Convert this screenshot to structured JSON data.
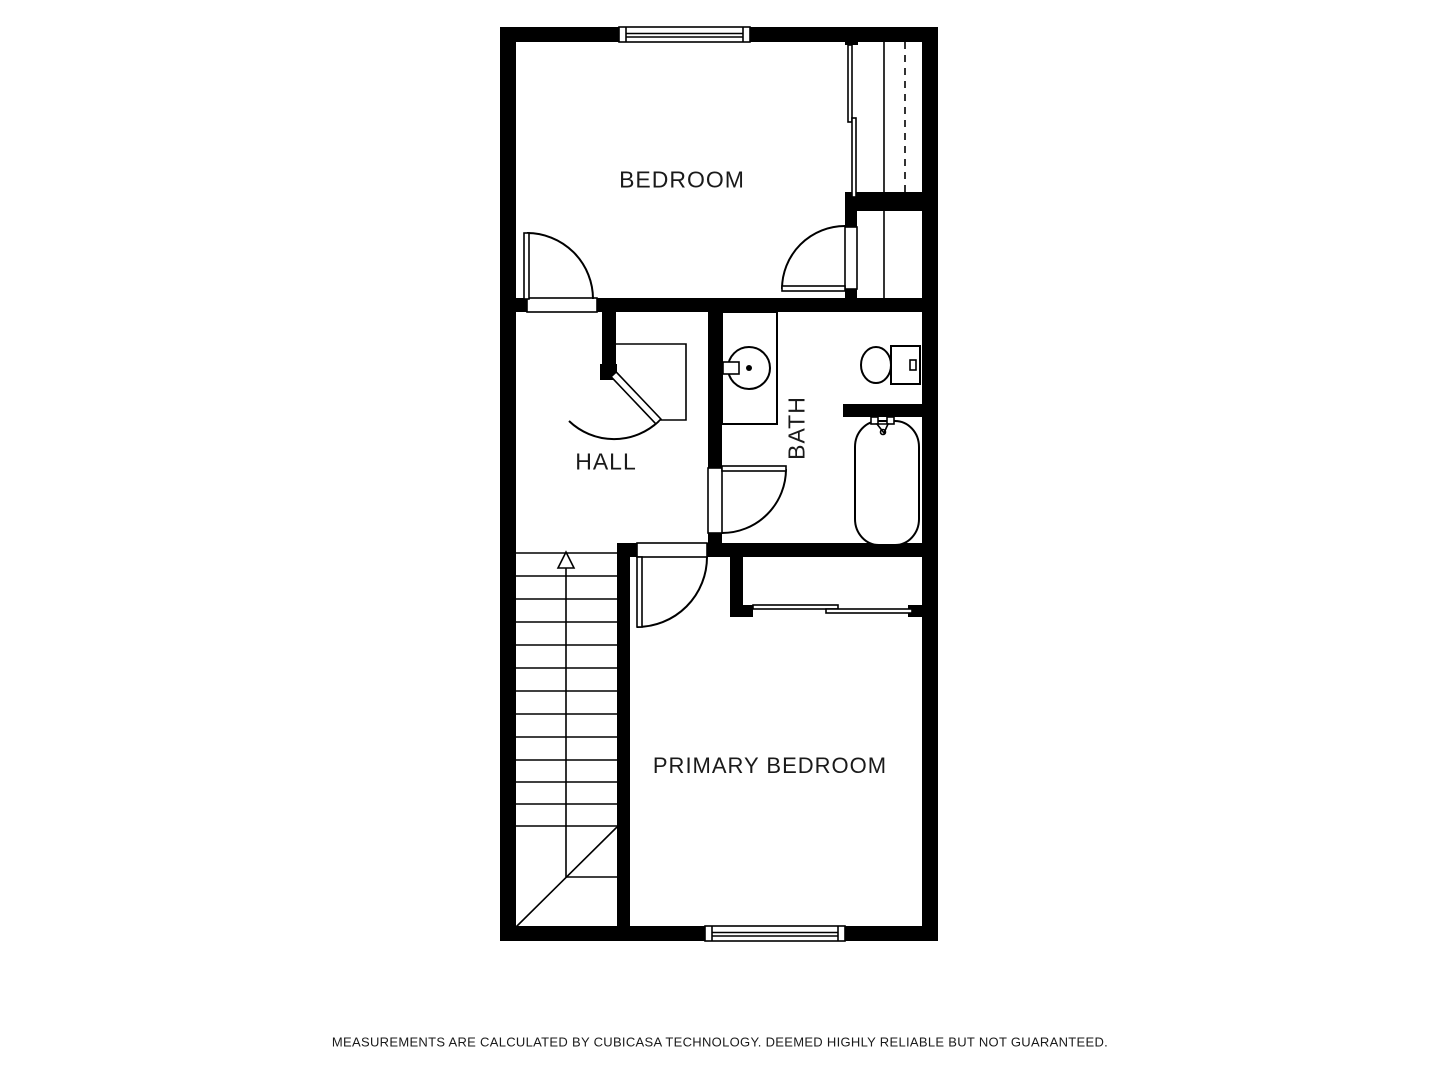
{
  "floorplan": {
    "type": "floor-plan",
    "rooms": [
      {
        "id": "bedroom",
        "label": "BEDROOM"
      },
      {
        "id": "hall",
        "label": "HALL"
      },
      {
        "id": "bath",
        "label": "BATH"
      },
      {
        "id": "primary_bedroom",
        "label": "PRIMARY BEDROOM"
      }
    ],
    "fixtures": [
      "staircase-up",
      "hinged-doors",
      "sliding-closet-doors",
      "wardrobe-with-rod",
      "bathroom-sink-vanity",
      "toilet",
      "bathtub",
      "windows"
    ],
    "colors": {
      "wall": "#000000",
      "floor": "#ffffff",
      "line": "#000000",
      "text": "#1a1a1a"
    }
  },
  "footer": {
    "disclaimer": "MEASUREMENTS ARE CALCULATED BY CUBICASA TECHNOLOGY. DEEMED HIGHLY RELIABLE BUT NOT GUARANTEED."
  }
}
